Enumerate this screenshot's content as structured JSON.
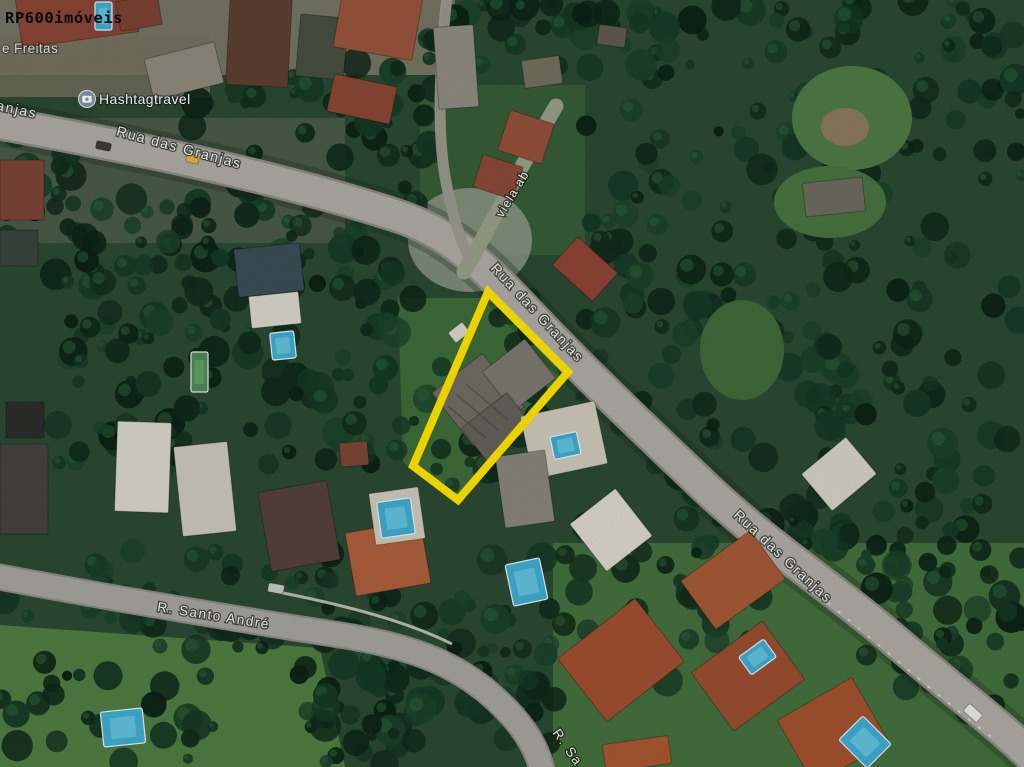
{
  "map": {
    "kind": "satellite-imagery-listing",
    "highlight_color": "#FFE400"
  },
  "labels": {
    "watermark": "RP600imóveis",
    "poi_hashtagtravel": "Hashtagtravel",
    "poi_freitas": "e Freitas",
    "street_granjas_partial_left": "anjas",
    "street_granjas_upper": "Rua das Granjas",
    "street_granjas_middle": "Rua das Granjas",
    "street_granjas_lower": "Rua das Granjas",
    "street_viela": "viela ab",
    "street_santo_andre": "R. Santo André",
    "street_santo_andre_partial": "R. Sa"
  }
}
